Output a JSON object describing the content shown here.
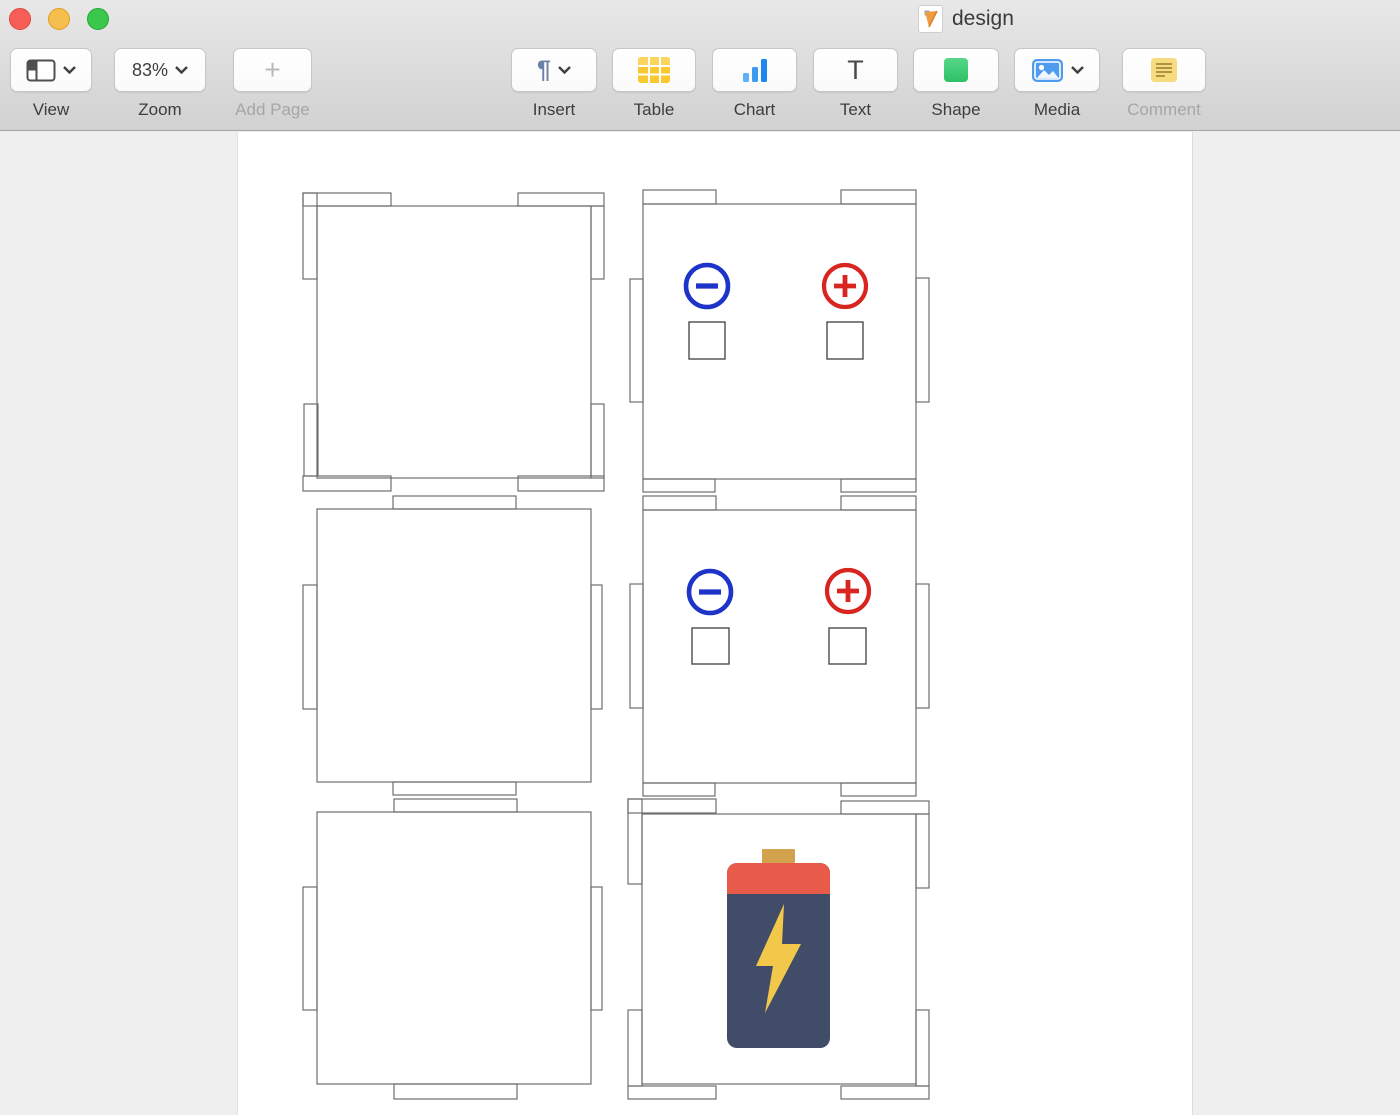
{
  "window": {
    "title": "design",
    "app_icon": "pages-document-icon"
  },
  "toolbar": {
    "view": {
      "label": "View"
    },
    "zoom": {
      "label": "Zoom",
      "value": "83%"
    },
    "add_page": {
      "label": "Add Page",
      "glyph": "+"
    },
    "insert": {
      "label": "Insert",
      "glyph": "¶"
    },
    "table": {
      "label": "Table"
    },
    "chart": {
      "label": "Chart"
    },
    "text": {
      "label": "Text",
      "glyph": "T"
    },
    "shape": {
      "label": "Shape"
    },
    "media": {
      "label": "Media"
    },
    "comment": {
      "label": "Comment"
    }
  },
  "canvas": {
    "description": "Six laser-cut box face outlines; two faces carry battery terminal markings, one face carries a battery illustration",
    "colors": {
      "outline": "#6f6f6f",
      "inner_square": "#4c4c4c",
      "negative": "#1e34c8",
      "positive": "#d8251f",
      "battery_body": "#414d68",
      "battery_band": "#e85a49",
      "battery_cap": "#d3a24c",
      "battery_bolt": "#f2c84b"
    }
  }
}
